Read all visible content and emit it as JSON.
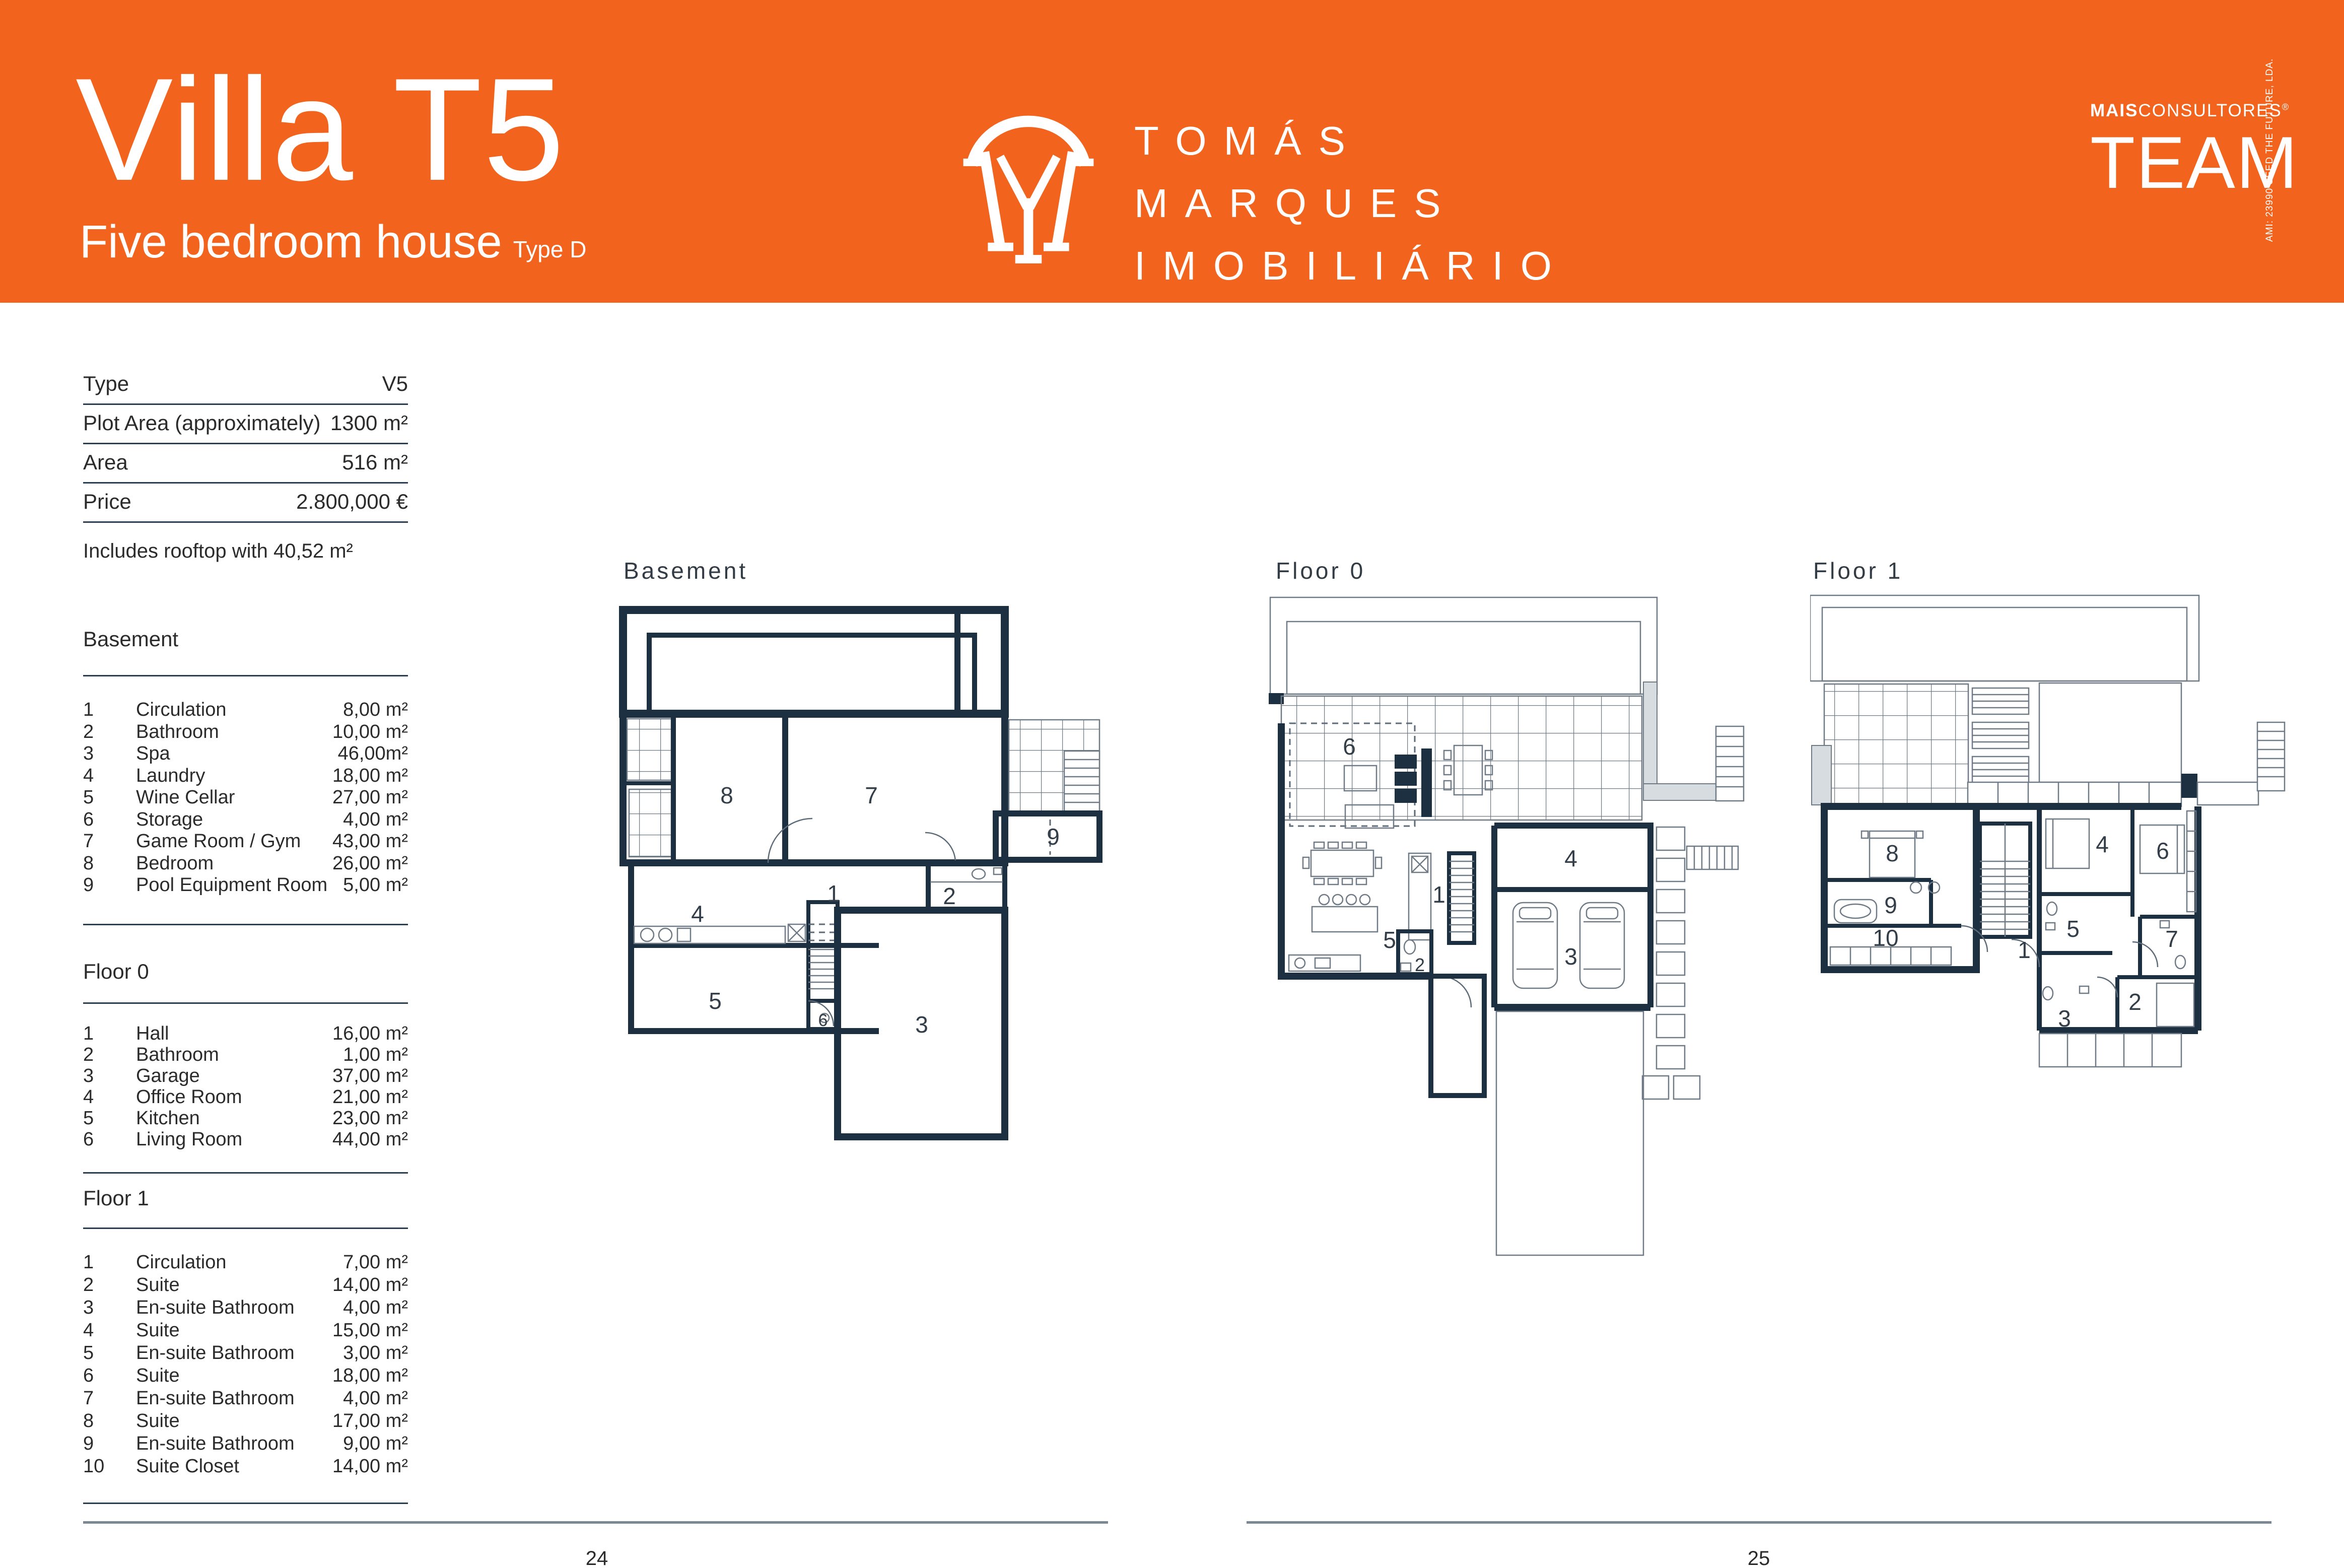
{
  "colors": {
    "accent": "#F2641E",
    "wall": "#1D3042",
    "divider": "#2C3F52",
    "footer_line": "#7C8794"
  },
  "header": {
    "title": "Villa T5",
    "subtitle": "Five bedroom house",
    "type_tag": "Type D",
    "brand": {
      "line1": "TOMÁS",
      "line2": "MARQUES",
      "line3": "IMOBILIÁRIO"
    },
    "partner": {
      "bold": "MAIS",
      "rest": "CONSULTORES",
      "reg": "®",
      "team": "TEAM",
      "vertical": "AMI: 23990  SEED THE FUTURE, LDA."
    }
  },
  "specs": {
    "rows": [
      {
        "label": "Type",
        "value": "V5"
      },
      {
        "label": "Plot Area (approximately)",
        "value": "1300 m²"
      },
      {
        "label": "Area",
        "value": "516 m²"
      },
      {
        "label": "Price",
        "value": "2.800,000 €"
      }
    ],
    "note": "Includes rooftop with 40,52 m²"
  },
  "sections": [
    {
      "title": "Basement",
      "rows": [
        [
          "1",
          "Circulation",
          "8,00 m²"
        ],
        [
          "2",
          "Bathroom",
          "10,00 m²"
        ],
        [
          "3",
          "Spa",
          "46,00m²"
        ],
        [
          "4",
          "Laundry",
          "18,00 m²"
        ],
        [
          "5",
          "Wine Cellar",
          "27,00 m²"
        ],
        [
          "6",
          "Storage",
          "4,00 m²"
        ],
        [
          "7",
          "Game Room / Gym",
          "43,00 m²"
        ],
        [
          "8",
          "Bedroom",
          "26,00 m²"
        ],
        [
          "9",
          "Pool Equipment Room",
          "5,00 m²"
        ]
      ]
    },
    {
      "title": "Floor 0",
      "rows": [
        [
          "1",
          "Hall",
          "16,00 m²"
        ],
        [
          "2",
          "Bathroom",
          "1,00 m²"
        ],
        [
          "3",
          "Garage",
          "37,00 m²"
        ],
        [
          "4",
          "Office Room",
          "21,00 m²"
        ],
        [
          "5",
          "Kitchen",
          "23,00 m²"
        ],
        [
          "6",
          "Living Room",
          "44,00 m²"
        ]
      ]
    },
    {
      "title": "Floor 1",
      "rows": [
        [
          "1",
          "Circulation",
          "7,00 m²"
        ],
        [
          "2",
          "Suite",
          "14,00 m²"
        ],
        [
          "3",
          "En-suite Bathroom",
          "4,00 m²"
        ],
        [
          "4",
          "Suite",
          "15,00 m²"
        ],
        [
          "5",
          "En-suite Bathroom",
          "3,00 m²"
        ],
        [
          "6",
          "Suite",
          "18,00 m²"
        ],
        [
          "7",
          "En-suite Bathroom",
          "4,00 m²"
        ],
        [
          "8",
          "Suite",
          "17,00 m²"
        ],
        [
          "9",
          "En-suite Bathroom",
          "9,00 m²"
        ],
        [
          "10",
          "Suite Closet",
          "14,00 m²"
        ]
      ]
    }
  ],
  "plans": [
    {
      "label": "Basement",
      "rooms": [
        "8",
        "7",
        "9",
        "1",
        "2",
        "4",
        "5",
        "6",
        "3"
      ]
    },
    {
      "label": "Floor 0",
      "rooms": [
        "6",
        "1",
        "2",
        "3",
        "4",
        "5"
      ]
    },
    {
      "label": "Floor 1",
      "rooms": [
        "8",
        "9",
        "10",
        "1",
        "4",
        "5",
        "6",
        "7",
        "2",
        "3"
      ]
    }
  ],
  "footer": {
    "left_page": "24",
    "right_page": "25"
  }
}
